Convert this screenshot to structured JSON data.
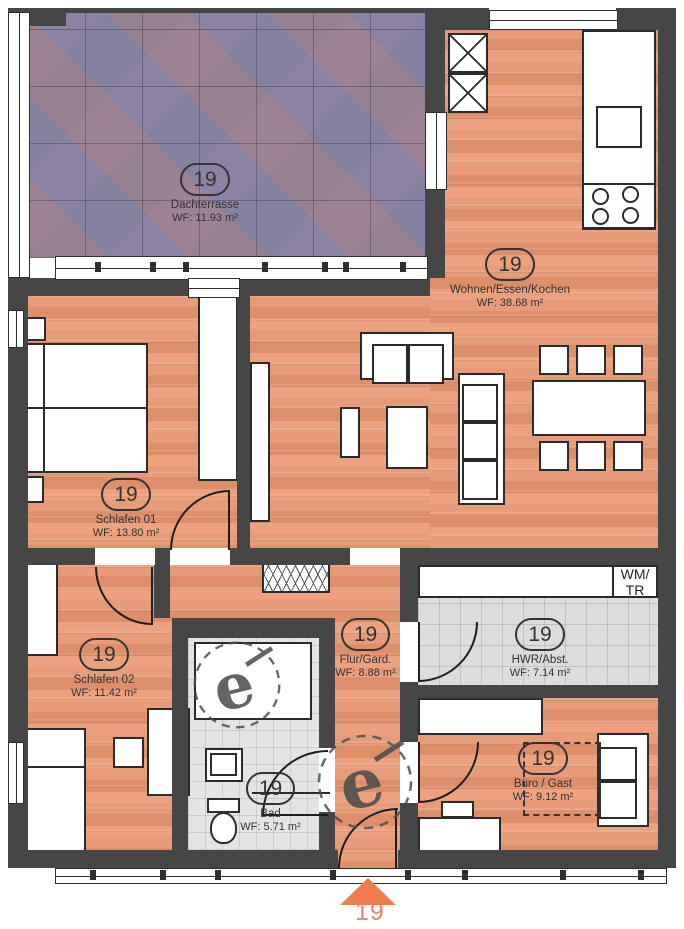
{
  "unit": {
    "number": "19"
  },
  "rooms": [
    {
      "badge": "19",
      "name": "Dachterrasse",
      "area": "WF: 11.93 m²"
    },
    {
      "badge": "19",
      "name": "Wohnen/Essen/Kochen",
      "area": "WF: 38.68 m²"
    },
    {
      "badge": "19",
      "name": "Schlafen 01",
      "area": "WF: 13.80 m²"
    },
    {
      "badge": "19",
      "name": "Schlafen 02",
      "area": "WF: 11.42 m²"
    },
    {
      "badge": "19",
      "name": "Flur/Gard.",
      "area": "WF: 8.88 m²"
    },
    {
      "badge": "19",
      "name": "HWR/Abst.",
      "area": "WF: 7.14 m²"
    },
    {
      "badge": "19",
      "name": "Bad",
      "area": "WF: 5.71 m²"
    },
    {
      "badge": "19",
      "name": "Büro / Gast",
      "area": "WF: 9.12 m²"
    }
  ],
  "appliances": {
    "wm_tr_line1": "WM/",
    "wm_tr_line2": "TR"
  },
  "entrance": {
    "label": "19"
  },
  "colors": {
    "wall": "#464646",
    "wood": "#e59a77",
    "terrace_tile": "#938aa0",
    "gray_tile": "#dcdcdc",
    "accent": "#ed7d4e"
  }
}
